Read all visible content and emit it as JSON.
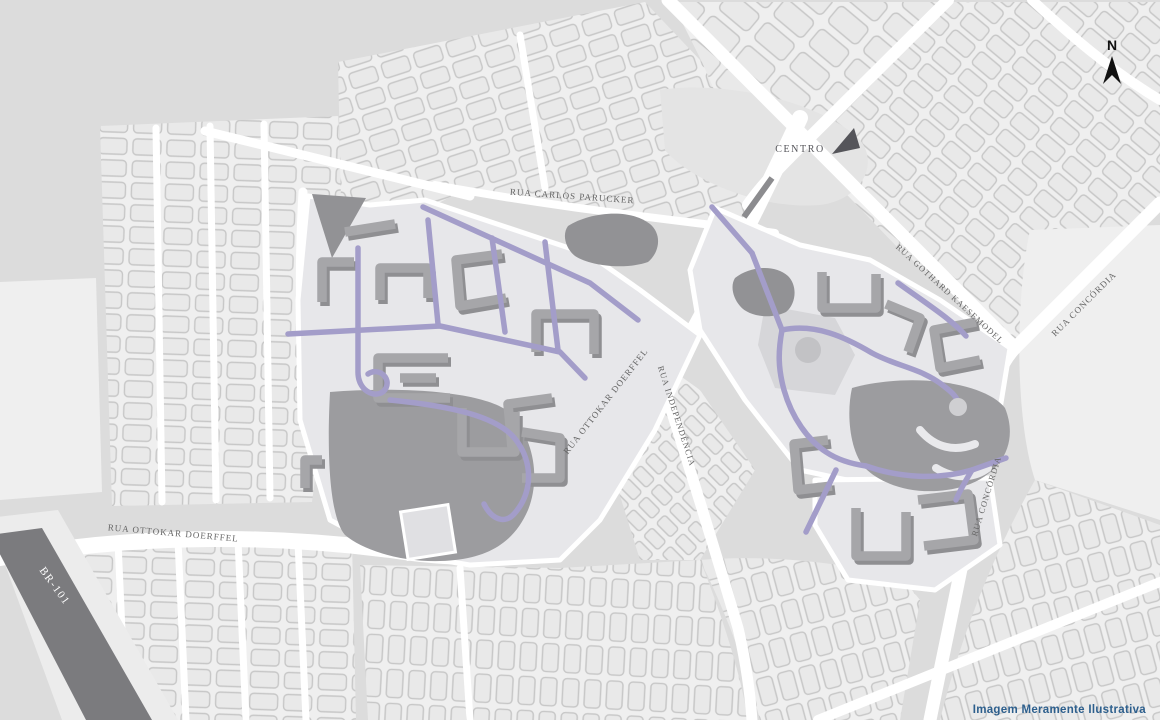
{
  "map": {
    "title": "Mapa ilustrativo de localização",
    "labels": {
      "north": "N",
      "centro": "CENTRO",
      "carlos_parucker": "RUA CARLOS PARUCKER",
      "gothard_kaesemodel": "RUA GOTHARD KAESEMODEL",
      "concordia_top": "RUA CONCÓRDIA",
      "concordia_side": "RUA CONCÓRDIA",
      "ottokar_diag": "RUA OTTOKAR DOERFFEL",
      "ottokar_bottom": "RUA OTTOKAR DOERFFEL",
      "independencia": "RUA INDEPENDÊNCIA",
      "br101": "BR-101",
      "disclaimer": "Imagem Meramente Ilustrativa"
    }
  },
  "colors": {
    "base": "#dcdcdc",
    "area": "#efefef",
    "lot_fill": "#e9e9e9",
    "lot_stroke": "#c7c7c7",
    "road": "#ffffff",
    "parcel": "#e7e7ea",
    "zone_dark": "#9c9c9f",
    "plaza": "#d6d6d9",
    "building": "#a6a6a9",
    "building_shadow": "#8f8f92",
    "dark_block": "#929295",
    "purple_street": "#a39dc9",
    "median": "#8c8c8f",
    "br101": "#7b7b7e",
    "label": "#666666",
    "north": "#111111",
    "disclaimer": "#2d5f8d"
  }
}
